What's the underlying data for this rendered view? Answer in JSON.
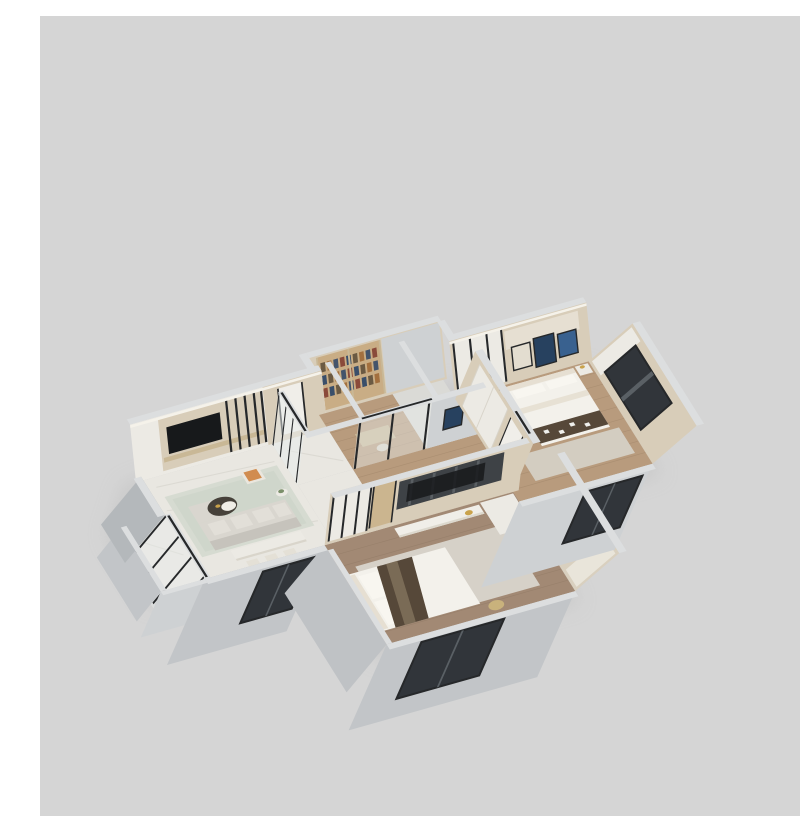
{
  "image": {
    "kind": "3d-isometric-floorplan-render",
    "caption": "3D dollhouse render of a three-room apartment",
    "background": "#d5d5d5"
  },
  "palette": {
    "bg": "#d5d5d5",
    "shadow": "#c2c2c2",
    "wallTop": "#dcdedf",
    "wallLight": "#ced1d3",
    "wallMid": "#c2c5c8",
    "wallMid2": "#bfc2c5",
    "wallDark": "#b4b8bb",
    "woodWall": "#d8cdb9",
    "woodWallDark": "#c9b896",
    "panel": "#eceae4",
    "bookWood": "#c9ad85",
    "books": [
      "#8a4a3a",
      "#3a4f6a",
      "#6b5a43",
      "#a3703f",
      "#44546b"
    ],
    "floorMarble": "#e9e7e1",
    "marbleVein": "#d9d7d0",
    "marbleLite": "#f3f2ed",
    "floorWood": "#b89b7d",
    "floorWoodDark": "#a28974",
    "plank": "#9d8266",
    "floorTile": "#dadad6",
    "rugLiving": "#d6dbd1",
    "rugInner": "#cbd2c6",
    "rugBed": "#d3cdc1",
    "rugMaster": "#d6d1c8",
    "glass": "#e8eded",
    "frame": "#26282a",
    "windowGlass": "#31353a",
    "windowLite": "#5a6065",
    "tv": "#17191b",
    "media": "#3e4246",
    "mediaLite": "#5a5f63",
    "lowboard": "#f0eee8",
    "sofa": "#d9d6cf",
    "sofaShade": "#c6c3bc",
    "bedWhite": "#f3f1eb",
    "bedFold": "#e7e1d4",
    "throw": "#564839",
    "throwLite": "#8a7a62",
    "headboard": "#e6dfd2",
    "pillow": "#f8f6f0",
    "orange": "#d18c4f",
    "plant": "#7b8f6a",
    "gold": "#c9a24b",
    "goldSoft": "#c9b27c",
    "doorWood": "#cbb58f",
    "doorWhite": "#f0eee9",
    "artBlue": "#39618f",
    "artNavy": "#27415f",
    "artLight": "#e3ddd0",
    "cove": "#f5f2ea"
  },
  "rooms": [
    {
      "name": "living-dining-room",
      "floor": "marble",
      "features": [
        "tv-cabinet-wall",
        "sofa",
        "round-coffee-table",
        "armchair",
        "side-table-plant",
        "dining-table",
        "dining-chairs",
        "rug"
      ]
    },
    {
      "name": "entry-hall",
      "floor": "marble",
      "features": [
        "entry-door",
        "wood-paneling",
        "glass-partition"
      ]
    },
    {
      "name": "study",
      "floor": "wood",
      "features": [
        "bookshelf",
        "desk",
        "glass-doors"
      ]
    },
    {
      "name": "bathroom",
      "floor": "tile",
      "features": [
        "wall-art"
      ]
    },
    {
      "name": "hallway",
      "floor": "wood",
      "features": []
    },
    {
      "name": "bedroom-right",
      "floor": "wood",
      "features": [
        "bed",
        "glass-wardrobe",
        "nightstands",
        "art-triptych",
        "east-window",
        "south-window"
      ]
    },
    {
      "name": "master-bedroom",
      "floor": "wood",
      "features": [
        "bed",
        "media-tv-wall",
        "lowboard",
        "glass-wardrobe",
        "door",
        "cabinet",
        "south-window"
      ]
    },
    {
      "name": "balcony",
      "floor": "marble",
      "features": [
        "glass-doors",
        "parapet-walls"
      ]
    }
  ]
}
